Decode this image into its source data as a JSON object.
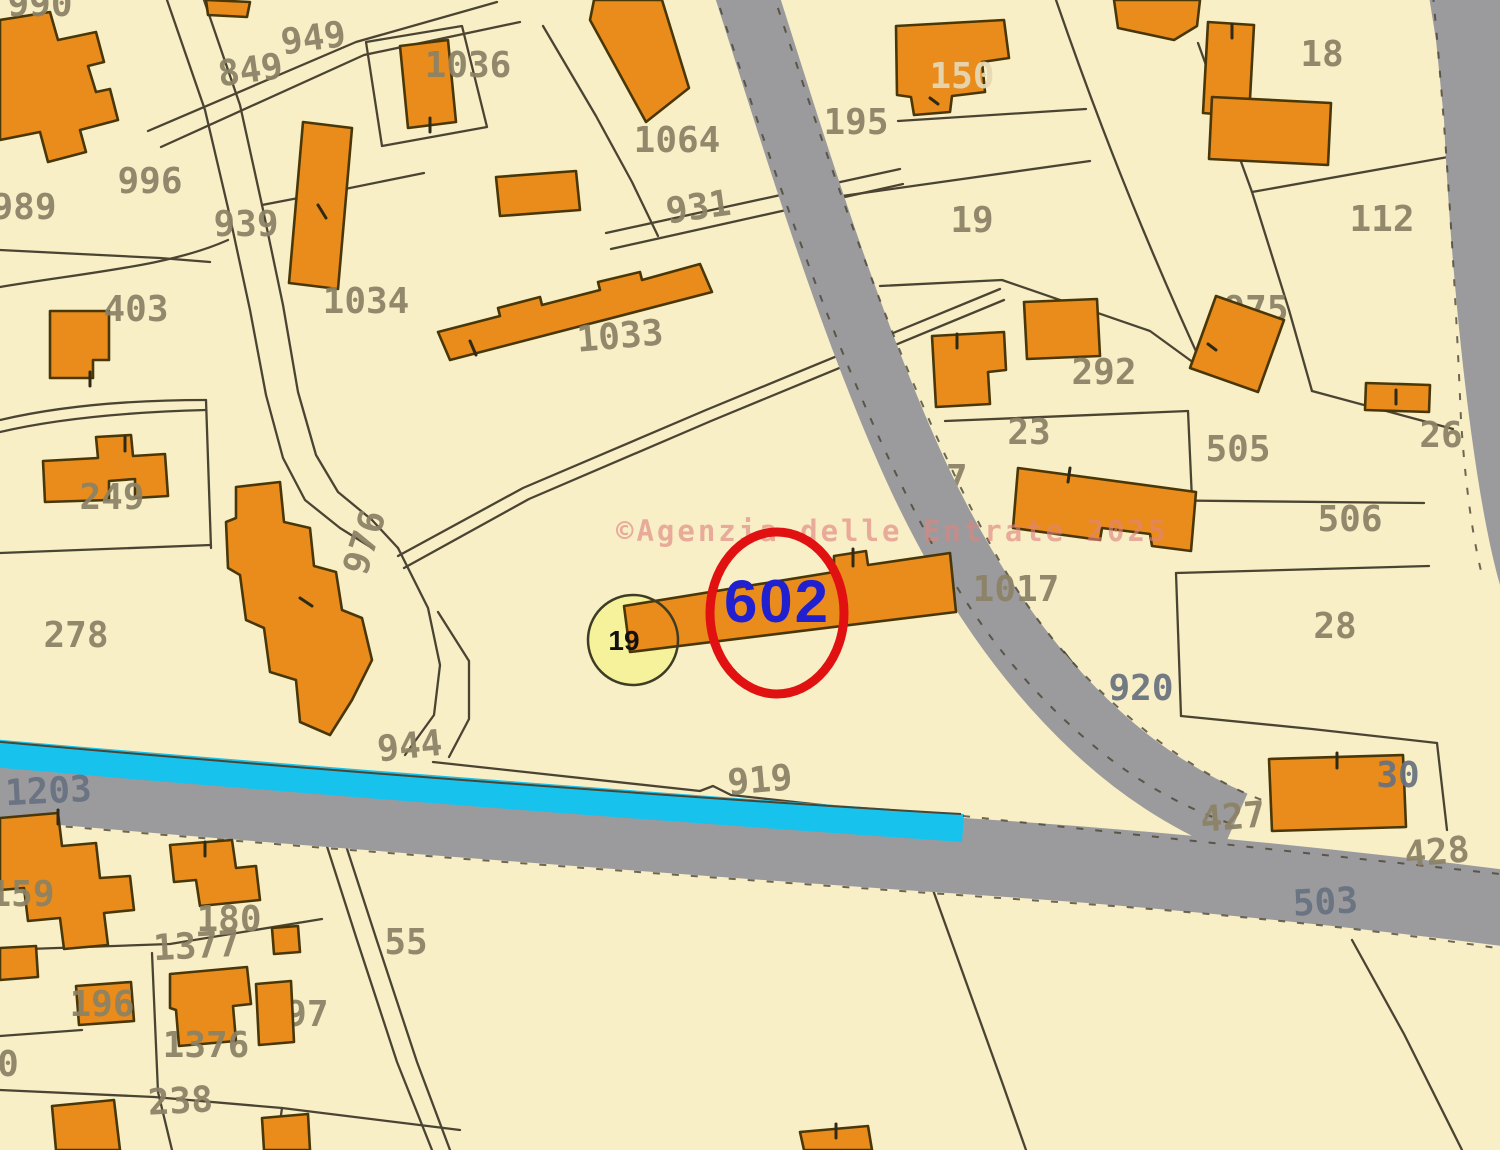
{
  "map": {
    "title": "cadastral-map",
    "colors": {
      "background": "#f8efc7",
      "building": "#e98c1b",
      "building_outline": "#4a3708",
      "boundary": "#4b4433",
      "road": "#9b9b9e",
      "water": "#17c3ec",
      "label": "#8b8266",
      "road_label": "#687280",
      "label_light": "#e6d9b4",
      "tick": "#2f2a16"
    },
    "watermark": {
      "text": "©Agenzia delle Entrate 2025",
      "color": "#e0837e"
    },
    "highlight": {
      "parcel_number": "602",
      "text_color": "#2020d0",
      "circle_color": "#e21111"
    },
    "marker": {
      "label": "19",
      "fill": "#f6f29b",
      "stroke": "#3f3c25",
      "text_color": "#111111"
    },
    "labels_under": [
      {
        "t": "19",
        "x": 972,
        "y": 232
      },
      {
        "t": "975",
        "x": 1256,
        "y": 321
      },
      {
        "t": "1377",
        "x": 197,
        "y": 958,
        "r": -3
      },
      {
        "t": "197",
        "x": 296,
        "y": 1026
      },
      {
        "t": "927",
        "x": 935,
        "y": 490
      }
    ],
    "labels_over": [
      {
        "t": "990",
        "x": 40,
        "y": 16
      },
      {
        "t": "949",
        "x": 315,
        "y": 50,
        "r": -8
      },
      {
        "t": "849",
        "x": 252,
        "y": 82,
        "r": -8
      },
      {
        "t": "1036",
        "x": 468,
        "y": 77
      },
      {
        "t": "996",
        "x": 150,
        "y": 193
      },
      {
        "t": "989",
        "x": 24,
        "y": 219
      },
      {
        "t": "939",
        "x": 246,
        "y": 236
      },
      {
        "t": "1064",
        "x": 677,
        "y": 152
      },
      {
        "t": "931",
        "x": 700,
        "y": 219,
        "r": -8
      },
      {
        "t": "1034",
        "x": 366,
        "y": 313
      },
      {
        "t": "1033",
        "x": 621,
        "y": 348,
        "r": -5
      },
      {
        "t": "403",
        "x": 136,
        "y": 321
      },
      {
        "t": "249",
        "x": 112,
        "y": 509
      },
      {
        "t": "278",
        "x": 76,
        "y": 647
      },
      {
        "t": "976",
        "x": 376,
        "y": 546,
        "r": -72
      },
      {
        "t": "944",
        "x": 411,
        "y": 758,
        "r": -6
      },
      {
        "t": "195",
        "x": 856,
        "y": 134
      },
      {
        "t": "150",
        "x": 962,
        "y": 88,
        "c": "#e6d9b4"
      },
      {
        "t": "18",
        "x": 1322,
        "y": 66
      },
      {
        "t": "112",
        "x": 1382,
        "y": 231
      },
      {
        "t": "292",
        "x": 1104,
        "y": 384
      },
      {
        "t": "23",
        "x": 1029,
        "y": 444
      },
      {
        "t": "26",
        "x": 1441,
        "y": 447
      },
      {
        "t": "505",
        "x": 1238,
        "y": 461
      },
      {
        "t": "506",
        "x": 1350,
        "y": 531
      },
      {
        "t": "1017",
        "x": 1016,
        "y": 601
      },
      {
        "t": "28",
        "x": 1335,
        "y": 638
      },
      {
        "t": "920",
        "x": 1141,
        "y": 700,
        "c": "#687280"
      },
      {
        "t": "30",
        "x": 1398,
        "y": 787,
        "c": "#687280"
      },
      {
        "t": "427",
        "x": 1234,
        "y": 829,
        "r": -5
      },
      {
        "t": "428",
        "x": 1438,
        "y": 864,
        "r": -5
      },
      {
        "t": "503",
        "x": 1326,
        "y": 914,
        "r": -3,
        "c": "#687280"
      },
      {
        "t": "1203",
        "x": 49,
        "y": 803,
        "r": -3,
        "c": "#687280"
      },
      {
        "t": "919",
        "x": 761,
        "y": 792,
        "r": -5
      },
      {
        "t": "55",
        "x": 406,
        "y": 954
      },
      {
        "t": "159",
        "x": 22,
        "y": 906
      },
      {
        "t": "180",
        "x": 229,
        "y": 931
      },
      {
        "t": "196",
        "x": 102,
        "y": 1016
      },
      {
        "t": "1376",
        "x": 206,
        "y": 1057
      },
      {
        "t": "238",
        "x": 181,
        "y": 1113,
        "r": -3
      },
      {
        "t": "0",
        "x": 8,
        "y": 1076
      }
    ]
  }
}
